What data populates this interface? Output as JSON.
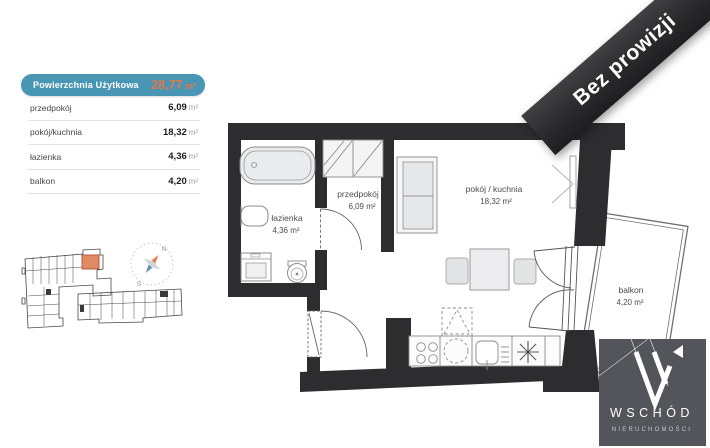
{
  "area_table": {
    "header": {
      "label": "Powierzchnia Użytkowa",
      "value": "28,77",
      "unit": "m²"
    },
    "rows": [
      {
        "label": "przedpokój",
        "value": "6,09",
        "unit": "m²"
      },
      {
        "label": "pokój/kuchnia",
        "value": "18,32",
        "unit": "m²"
      },
      {
        "label": "łazienka",
        "value": "4,36",
        "unit": "m²"
      },
      {
        "label": "balkon",
        "value": "4,20",
        "unit": "m²"
      }
    ]
  },
  "ribbon": {
    "label": "Bez prowizji"
  },
  "floorplan": {
    "rooms": [
      {
        "name": "łazienka",
        "area": "4,36 m²"
      },
      {
        "name": "przedpokój",
        "area": "6,09 m²"
      },
      {
        "name": "pokój / kuchnia",
        "area": "18,32 m²"
      },
      {
        "name": "balkon",
        "area": "4,20 m²"
      }
    ]
  },
  "compass": {
    "north": "N",
    "south": "S"
  },
  "logo": {
    "brand": "WSCHÓD",
    "subtitle": "NIERUCHOMOŚCI"
  },
  "colors": {
    "table_header_bg": "#4896b4",
    "accent_orange": "#e5764d",
    "wall": "#2d2d2f",
    "ribbon_bg": "#2b2b2d",
    "logo_bg": "#54555a",
    "site_unit_highlight": "#e08a64"
  }
}
